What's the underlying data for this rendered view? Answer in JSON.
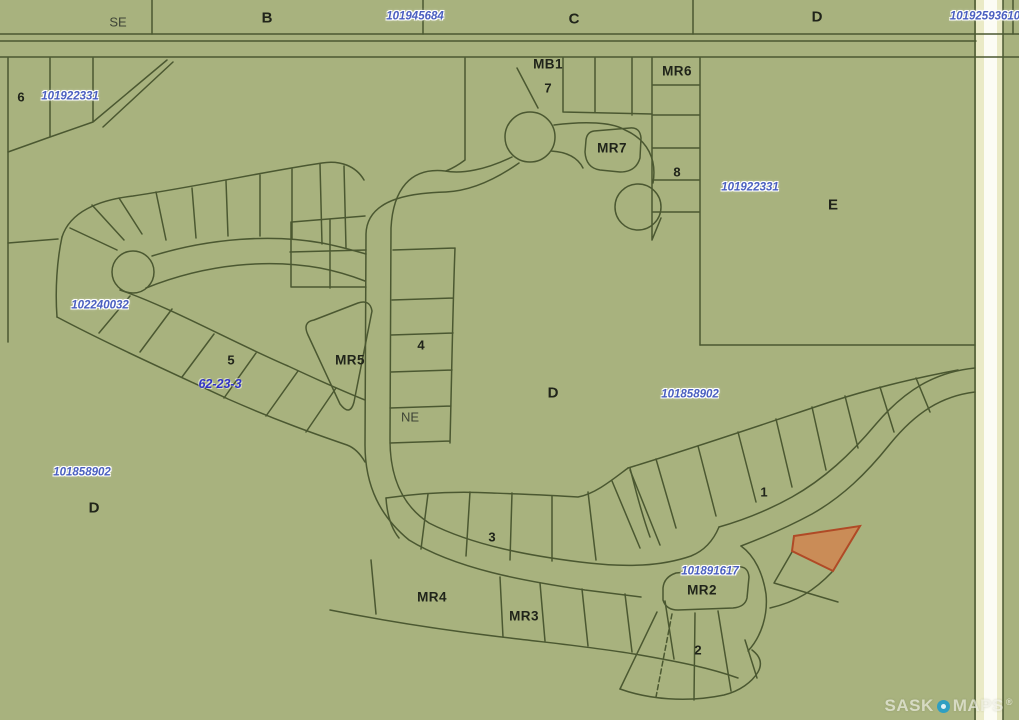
{
  "map": {
    "background_color": "#a8b27e",
    "line_color": "#4b5831",
    "road_fill": "#eaeac6",
    "road_stripe": "#fcfcf4",
    "highlight_parcel": {
      "fill": "#d2824d",
      "stroke": "#b04a26"
    },
    "label_colors": {
      "black": "#20241a",
      "parcel_blue": "#4a5fc0",
      "plan_blue": "#3032c8",
      "quarter_gray": "#3e4436"
    },
    "labels": [
      {
        "text": "SE",
        "x": 118,
        "y": 22,
        "type": "quarter",
        "name": "label-quarter-se"
      },
      {
        "text": "B",
        "x": 267,
        "y": 18,
        "type": "block-letter",
        "name": "label-block-b"
      },
      {
        "text": "101945684",
        "x": 415,
        "y": 17,
        "type": "parcel-blue",
        "name": "label-parcel-101945684"
      },
      {
        "text": "C",
        "x": 574,
        "y": 19,
        "type": "block-letter",
        "name": "label-block-c"
      },
      {
        "text": "D",
        "x": 817,
        "y": 17,
        "type": "block-letter",
        "name": "label-block-d-top"
      },
      {
        "text": "10192593610",
        "x": 985,
        "y": 17,
        "type": "parcel-blue",
        "name": "label-parcel-10192593610"
      },
      {
        "text": "6",
        "x": 21,
        "y": 97,
        "type": "lot-number",
        "name": "label-lot-6"
      },
      {
        "text": "101922331",
        "x": 70,
        "y": 97,
        "type": "parcel-blue",
        "name": "label-parcel-101922331-left"
      },
      {
        "text": "MB1",
        "x": 548,
        "y": 64,
        "type": "reserve",
        "name": "label-reserve-mb1"
      },
      {
        "text": "7",
        "x": 548,
        "y": 88,
        "type": "lot-number",
        "name": "label-lot-7"
      },
      {
        "text": "MR6",
        "x": 677,
        "y": 71,
        "type": "reserve",
        "name": "label-reserve-mr6"
      },
      {
        "text": "MR7",
        "x": 612,
        "y": 148,
        "type": "reserve",
        "name": "label-reserve-mr7"
      },
      {
        "text": "8",
        "x": 677,
        "y": 172,
        "type": "lot-number",
        "name": "label-lot-8"
      },
      {
        "text": "101922331",
        "x": 750,
        "y": 188,
        "type": "parcel-blue",
        "name": "label-parcel-101922331-right"
      },
      {
        "text": "E",
        "x": 833,
        "y": 205,
        "type": "block-letter",
        "name": "label-block-e"
      },
      {
        "text": "102240032",
        "x": 100,
        "y": 306,
        "type": "parcel-blue",
        "name": "label-parcel-102240032"
      },
      {
        "text": "5",
        "x": 231,
        "y": 360,
        "type": "lot-number",
        "name": "label-lot-5"
      },
      {
        "text": "62-23-3",
        "x": 220,
        "y": 384,
        "type": "plan-blue",
        "name": "label-plan-62-23-3"
      },
      {
        "text": "MR5",
        "x": 350,
        "y": 360,
        "type": "reserve",
        "name": "label-reserve-mr5"
      },
      {
        "text": "4",
        "x": 421,
        "y": 345,
        "type": "lot-number",
        "name": "label-lot-4"
      },
      {
        "text": "NE",
        "x": 410,
        "y": 417,
        "type": "quarter",
        "name": "label-quarter-ne"
      },
      {
        "text": "D",
        "x": 553,
        "y": 393,
        "type": "block-letter",
        "name": "label-block-d-center"
      },
      {
        "text": "101858902",
        "x": 690,
        "y": 395,
        "type": "parcel-blue",
        "name": "label-parcel-101858902-center"
      },
      {
        "text": "101858902",
        "x": 82,
        "y": 473,
        "type": "parcel-blue",
        "name": "label-parcel-101858902-left"
      },
      {
        "text": "D",
        "x": 94,
        "y": 508,
        "type": "block-letter",
        "name": "label-block-d-left"
      },
      {
        "text": "1",
        "x": 764,
        "y": 492,
        "type": "lot-number",
        "name": "label-lot-1"
      },
      {
        "text": "3",
        "x": 492,
        "y": 537,
        "type": "lot-number",
        "name": "label-lot-3"
      },
      {
        "text": "101891617",
        "x": 710,
        "y": 572,
        "type": "parcel-blue",
        "name": "label-parcel-101891617"
      },
      {
        "text": "MR4",
        "x": 432,
        "y": 597,
        "type": "reserve",
        "name": "label-reserve-mr4"
      },
      {
        "text": "MR3",
        "x": 524,
        "y": 616,
        "type": "reserve",
        "name": "label-reserve-mr3"
      },
      {
        "text": "MR2",
        "x": 702,
        "y": 590,
        "type": "reserve",
        "name": "label-reserve-mr2"
      },
      {
        "text": "2",
        "x": 698,
        "y": 650,
        "type": "lot-number",
        "name": "label-lot-2"
      }
    ],
    "watermark": {
      "sask": "SASK",
      "maps": "MAPS",
      "registered": "®"
    }
  }
}
